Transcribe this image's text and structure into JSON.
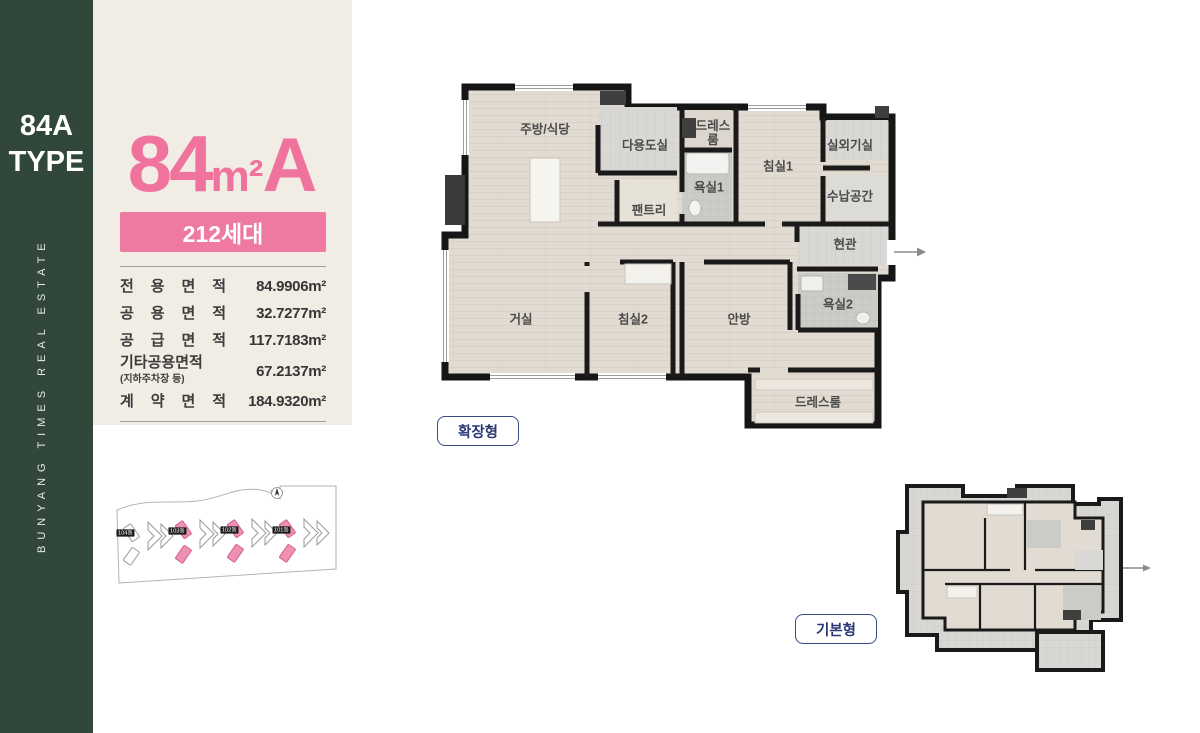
{
  "sidebar": {
    "type_line1": "84A",
    "type_line2": "TYPE",
    "vertical_text": "BUNYANG TIMES REAL ESTATE"
  },
  "info_panel": {
    "title_number": "84",
    "title_unit": "m²",
    "title_suffix": "A",
    "units_badge": "212세대",
    "area_table": [
      {
        "label": "전 용 면 적",
        "value": "84.9906m²"
      },
      {
        "label": "공 용 면 적",
        "value": "32.7277m²"
      },
      {
        "label": "공 급 면 적",
        "value": "117.7183m²"
      },
      {
        "label": "기타공용면적",
        "sublabel": "(지하주차장 등)",
        "value": "67.2137m²"
      },
      {
        "label": "계 약 면 적",
        "value": "184.9320m²"
      }
    ]
  },
  "site_plan": {
    "buildings": [
      "104동",
      "103동",
      "102동",
      "101동"
    ],
    "highlight_color": "#f08fb4"
  },
  "extended_plan": {
    "tag": "확장형",
    "rooms": {
      "kitchen": "주방/식당",
      "utility": "다용도실",
      "dress_top": "드레스룸",
      "bed1": "침실1",
      "outdoor_unit": "실외기실",
      "bath1": "욕실1",
      "pantry": "팬트리",
      "storage": "수납공간",
      "entrance": "현관",
      "living": "거실",
      "bed2": "침실2",
      "master": "안방",
      "bath2": "욕실2",
      "dress_bottom": "드레스룸"
    }
  },
  "basic_plan": {
    "tag": "기본형"
  }
}
